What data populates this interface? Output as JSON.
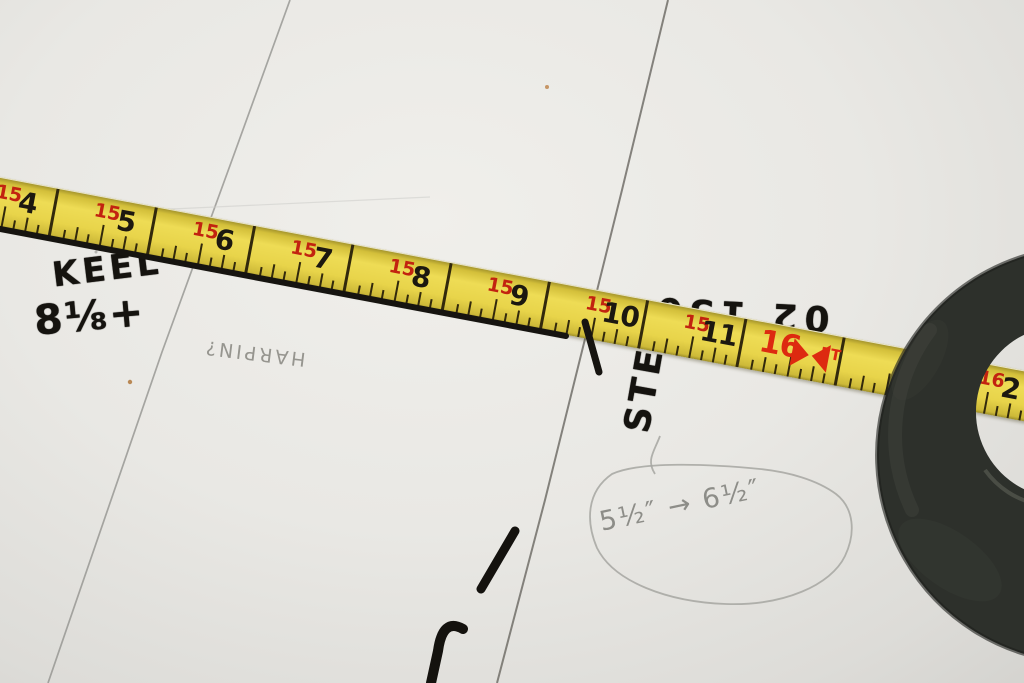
{
  "annotations": {
    "keel_label": "KEEL",
    "keel_value": "8⅛+",
    "stem_label": "STEM",
    "upside_down_note": "02 150",
    "pencil_name_note": "HARPIN?",
    "pencil_dimension_note": "5½″ → 6½″"
  },
  "tape": {
    "unit_label": "FT",
    "segments": [
      {
        "red": "15",
        "black": "4"
      },
      {
        "red": "15",
        "black": "5"
      },
      {
        "red": "15",
        "black": "6"
      },
      {
        "red": "15",
        "black": "7"
      },
      {
        "red": "15",
        "black": "8"
      },
      {
        "red": "15",
        "black": "9"
      },
      {
        "red": "15",
        "black": "10"
      },
      {
        "red": "15",
        "black": "11"
      },
      {
        "red": "16",
        "black": "",
        "type": "ft"
      },
      {
        "red": "",
        "black": "1"
      },
      {
        "red": "16",
        "black": "2"
      }
    ]
  },
  "colors": {
    "tape_yellow": "#e8d44a",
    "tape_red": "#d22510",
    "marker_black": "#15130f",
    "pencil_gray": "#96958f",
    "ring_black": "#2d302b",
    "surface_white": "#e9e8e4"
  }
}
